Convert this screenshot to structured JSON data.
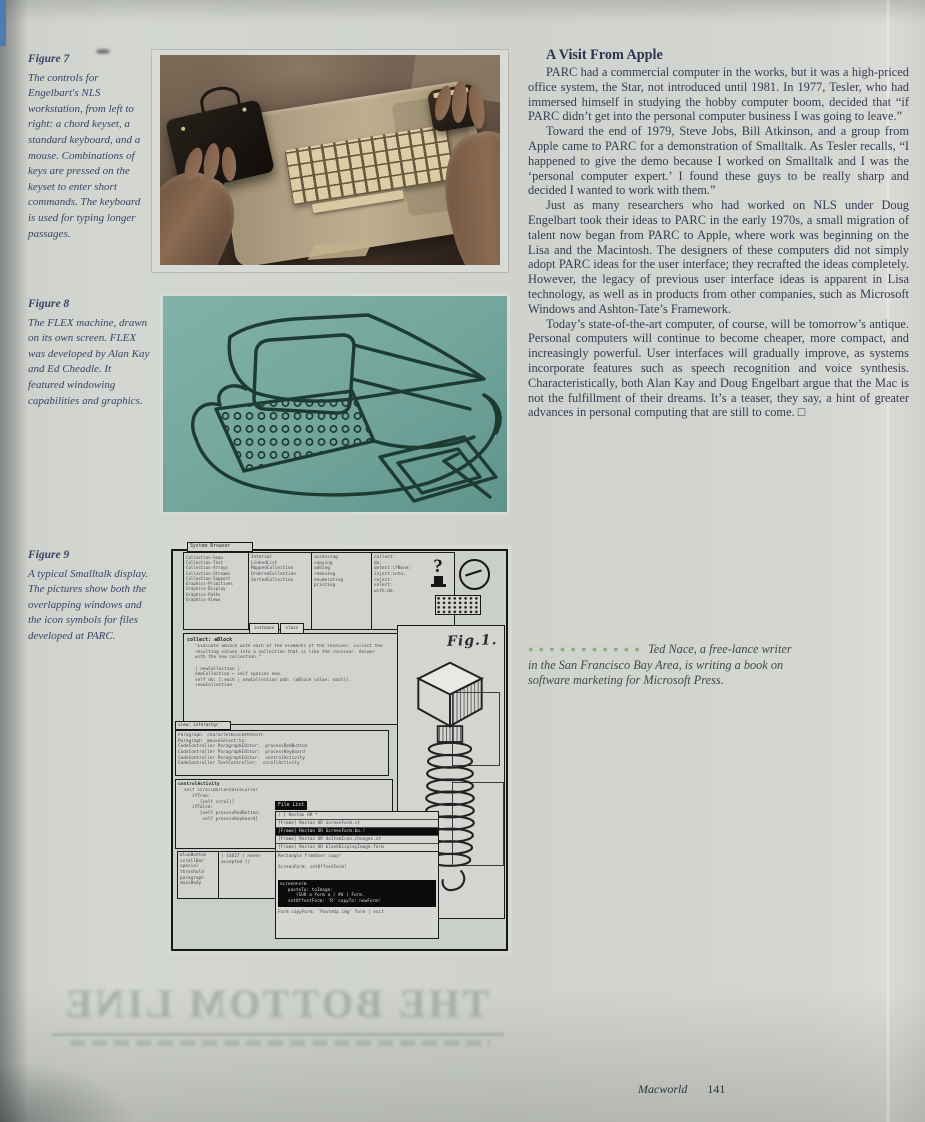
{
  "page": {
    "bleed_through_text": "THE BOTTOM LINE",
    "footer": {
      "magazine": "Macworld",
      "page_number": "141"
    }
  },
  "captions": {
    "fig7": {
      "label": "Figure 7",
      "text": "The controls for Engelbart's NLS workstation, from left to right: a chord keyset, a standard keyboard, and a mouse. Combinations of keys are pressed on the keyset to enter short commands. The keyboard is used for typing longer passages."
    },
    "fig8": {
      "label": "Figure 8",
      "text": "The FLEX machine, drawn on its own screen. FLEX was developed by Alan Kay and Ed Cheadle. It featured windowing capabilities and graphics."
    },
    "fig9": {
      "label": "Figure 9",
      "text": "A typical Smalltalk display. The pictures show both the overlapping windows and the icon symbols for files developed at PARC."
    }
  },
  "article": {
    "heading": "A Visit From Apple",
    "paragraphs": [
      "PARC had a commercial computer in the works, but it was a high-priced office system, the Star, not introduced until 1981. In 1977, Tesler, who had immersed himself in studying the hobby computer boom, decided that “if PARC didn’t get into the personal computer business I was going to leave.”",
      "Toward the end of 1979, Steve Jobs, Bill Atkinson, and a group from Apple came to PARC for a demonstration of Smalltalk. As Tesler recalls, “I happened to give the demo because I worked on Smalltalk and I was the ‘personal computer expert.’ I found these guys to be really sharp and decided I wanted to work with them.”",
      "Just as many researchers who had worked on NLS under Doug Engelbart took their ideas to PARC in the early 1970s, a small migration of talent now began from PARC to Apple, where work was beginning on the Lisa and the Macintosh. The designers of these computers did not simply adopt PARC ideas for the user interface; they recrafted the ideas completely. However, the legacy of previous user interface ideas is apparent in Lisa technology, as well as in products from other companies, such as Microsoft Windows and Ashton-Tate’s Framework.",
      "Today’s state-of-the-art computer, of course, will be tomorrow’s antique. Personal computers will continue to become cheaper, more compact, and increasingly powerful. User interfaces will gradually improve, as systems incorporate features such as speech recognition and voice synthesis. Characteristically, both Alan Kay and Doug Engelbart argue that the Mac is not the fulfillment of their dreams. It’s a teaser, they say, a hint of greater advances in personal computing that are still to come.  □"
    ],
    "bio_dots": "●●●●●●●●●●●",
    "bio": "Ted Nace, a free-lance writer in the San Francisco Bay Area, is writing a book on software marketing for Microsoft Press."
  },
  "smalltalk": {
    "browser_title": "System Browser",
    "browser_col1": "Collection-Sequ\nCollection-Text\nCollection-Arrays\nCollection-Streams\nCollection-Support\nGraphics-Primitives\nGraphics-Display\nGraphics-Paths\nGraphics-Views",
    "browser_col2": "Interval\nLinkedList\nMappedCollection\nOrderedCollection\nSortedCollection",
    "browser_col3": "accessing\ncopying\nadding\nremoving\nenumerating\nprinting",
    "browser_col4": "collect:\ndo:\ndetect:ifNone:\ninject:into:\nreject:\nselect:\nwith:do:",
    "instance_button": "instance",
    "class_button": "class",
    "code_header": "collect: aBlock",
    "code_body": "\"Evaluate aBlock with each of the elements of the receiver. Collect the\nresulting values into a collection that is like the receiver. Answer\nwith the new collection.\"\n\n| newCollection |\nnewCollection ← self species new.\nself do: [:each | newCollection add: (aBlock value: each)].\n↑newCollection",
    "fig_label": "Fig.1.",
    "view_tab": "view: interactgr",
    "view_body": "Paragraph  characterBlockAtPoint:\nParagraph  mouseSelect:to:\nCodeController ParagraphEditor:  processRedButton\nCodeController ParagraphEditor:  processKeyboard\nCodeController ParagraphEditor:  controlActivity\nCodeController TextController:  scrollActivity",
    "ctrl_header": "controlActivity",
    "ctrl_body": "self scrollBarContainsCursor\n   ifTrue:\n      [self scroll]\n   ifFalse:\n      [self processRedButton.\n       self processKeyboard]",
    "mini_list": "blueButton\nscrollBar\nspecial\nthreshold\nparagraph\nmainBody",
    "mini_cell": "( 14627 ( never\naccepted ))",
    "filelist_title": "File List",
    "filelist_rows": [
      "( ) Rectan OR *",
      "[Frame] Rectan OR ScreenForm.st",
      "[Frame] Rectan OR ScreenForm.bo.!",
      "[Frame] Rectan OR doItemIcon.changes.st",
      "[Frame] Rectan OR blankDisplayImage.form"
    ],
    "filelist_pane": "Rectangle fromUser copy!\n\nScreenForm: setOffsetForm!",
    "filelist_black": "ScreenForm\n   pasteTo: toImage:\n      (SUR a form a ( #d ) Form.\n   setOffsetForm: 'R' copyTo: newForm!",
    "filelist_bottom": "Form copyForm: 'PasteUp.img' form | exit"
  },
  "colors": {
    "page_bg": "#cfd2cd",
    "body_text": "#343b53",
    "caption_text": "#3d4365",
    "bio_dots_green": "#8fa883",
    "fig8_teal": "#74a69c",
    "fig8_line": "#1d3b31",
    "photo_sepia_dark": "#342820",
    "photo_console_tan": "#b5a487"
  }
}
